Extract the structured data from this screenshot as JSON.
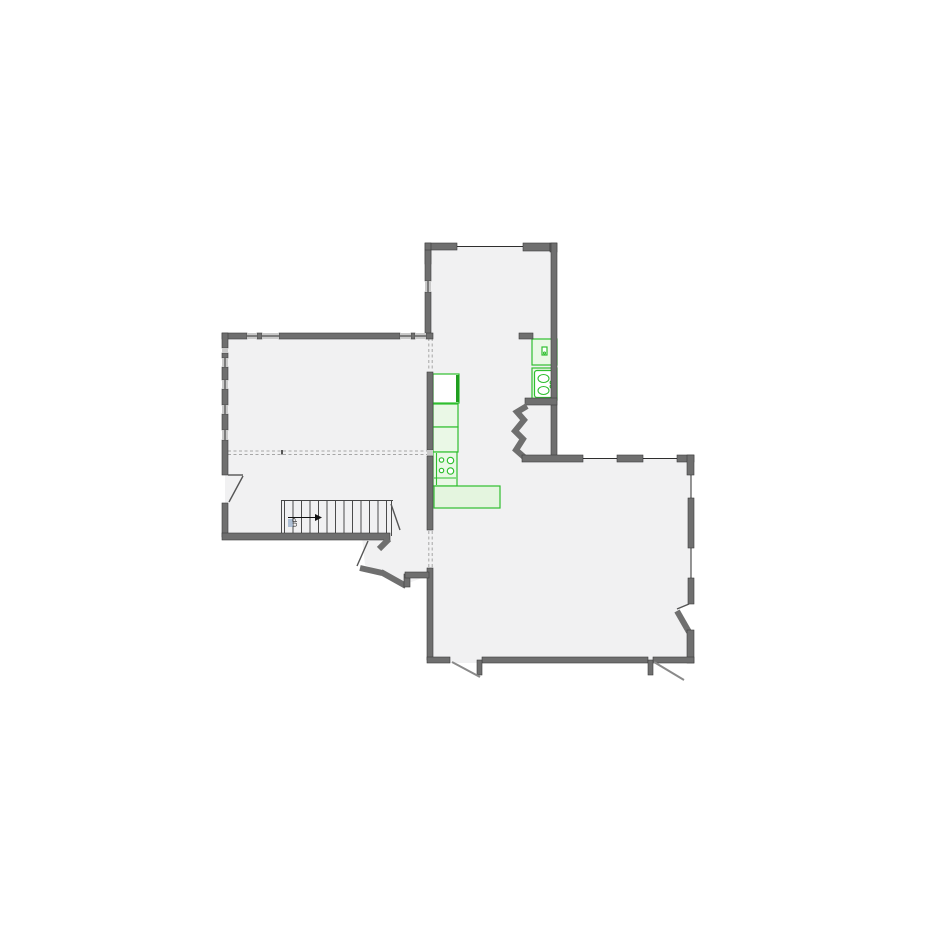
{
  "colors": {
    "wall-fill": "#6f6f6f",
    "wall-edge": "#3d3d3d",
    "room-fill": "#f1f1f2",
    "window-band": "#c9c9c9",
    "line-dark": "#2e2e2e",
    "leaf-gray": "#8a8a8a",
    "dash": "#a6a6a6",
    "fixture-green": "#2fbf2f",
    "fixture-fill": "#eaf8e6",
    "island-fill": "#e4f5df",
    "accent-green": "#1f9e1f",
    "label-blue": "#9db3cc",
    "page-bg": "#ffffff"
  },
  "stairs": {
    "label": "UP",
    "tread_count": 13
  },
  "fixture_icons": [
    "refrigerator-icon",
    "base-cabinet-icon",
    "range-4-burner-icon",
    "island-counter-icon",
    "washer-icon",
    "double-basin-sink-icon"
  ]
}
